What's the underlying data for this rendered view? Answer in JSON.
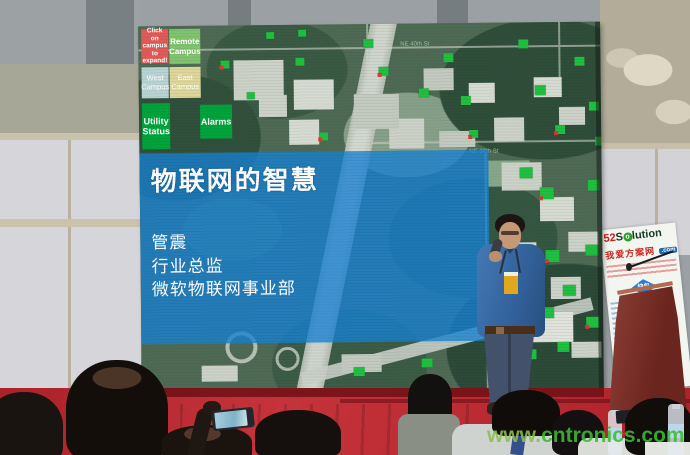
{
  "scene": {
    "description": "conference presentation photo",
    "watermark_prefix": "www.",
    "watermark_main": "cntronics.com",
    "stage_color": "#c2262e",
    "overlay_color": "#1782d4",
    "marker_color": "#1fc040"
  },
  "screen_ui": {
    "buttons": [
      {
        "label": "Click on campus to expand!",
        "color": "#e15a56"
      },
      {
        "label": "Remote Campus",
        "color": "#7fc36e"
      },
      {
        "label": "West Campus",
        "color": "#b7d3d3"
      },
      {
        "label": "East Campus",
        "color": "#ddd69a"
      },
      {
        "label": "Utility Status",
        "color": "#00a33c"
      },
      {
        "label": "Alarms",
        "color": "#00a33c"
      }
    ],
    "map_labels": [
      {
        "text": "NE 40th St",
        "x": 262,
        "y": 18
      },
      {
        "text": "NE 36th St",
        "x": 330,
        "y": 126
      }
    ],
    "markers": [
      {
        "x": 82,
        "y": 35,
        "w": 9,
        "h": 8,
        "red": true
      },
      {
        "x": 108,
        "y": 67,
        "w": 8,
        "h": 7,
        "red": false
      },
      {
        "x": 128,
        "y": 7,
        "w": 8,
        "h": 7,
        "red": false
      },
      {
        "x": 157,
        "y": 33,
        "w": 9,
        "h": 8,
        "red": false
      },
      {
        "x": 160,
        "y": 5,
        "w": 8,
        "h": 7,
        "red": false
      },
      {
        "x": 180,
        "y": 108,
        "w": 9,
        "h": 8,
        "red": true
      },
      {
        "x": 225,
        "y": 15,
        "w": 10,
        "h": 9,
        "red": false
      },
      {
        "x": 240,
        "y": 43,
        "w": 10,
        "h": 9,
        "red": true
      },
      {
        "x": 280,
        "y": 65,
        "w": 10,
        "h": 9,
        "red": false
      },
      {
        "x": 305,
        "y": 30,
        "w": 10,
        "h": 9,
        "red": false
      },
      {
        "x": 322,
        "y": 73,
        "w": 10,
        "h": 9,
        "red": false
      },
      {
        "x": 330,
        "y": 107,
        "w": 9,
        "h": 8,
        "red": true
      },
      {
        "x": 380,
        "y": 17,
        "w": 10,
        "h": 9,
        "red": false
      },
      {
        "x": 396,
        "y": 63,
        "w": 11,
        "h": 10,
        "red": false
      },
      {
        "x": 416,
        "y": 103,
        "w": 10,
        "h": 9,
        "red": true
      },
      {
        "x": 436,
        "y": 35,
        "w": 10,
        "h": 9,
        "red": false
      },
      {
        "x": 450,
        "y": 80,
        "w": 10,
        "h": 9,
        "red": false
      },
      {
        "x": 380,
        "y": 145,
        "w": 13,
        "h": 11,
        "red": false
      },
      {
        "x": 400,
        "y": 165,
        "w": 14,
        "h": 12,
        "red": true
      },
      {
        "x": 448,
        "y": 158,
        "w": 12,
        "h": 11,
        "red": false
      },
      {
        "x": 405,
        "y": 228,
        "w": 14,
        "h": 12,
        "red": true
      },
      {
        "x": 445,
        "y": 223,
        "w": 13,
        "h": 11,
        "red": false
      },
      {
        "x": 422,
        "y": 263,
        "w": 13,
        "h": 11,
        "red": false
      },
      {
        "x": 400,
        "y": 285,
        "w": 13,
        "h": 11,
        "red": false
      },
      {
        "x": 445,
        "y": 295,
        "w": 13,
        "h": 11,
        "red": true
      },
      {
        "x": 383,
        "y": 327,
        "w": 12,
        "h": 10,
        "red": false
      },
      {
        "x": 416,
        "y": 320,
        "w": 12,
        "h": 10,
        "red": false
      },
      {
        "x": 212,
        "y": 343,
        "w": 11,
        "h": 9,
        "red": false
      },
      {
        "x": 280,
        "y": 335,
        "w": 11,
        "h": 9,
        "red": false
      },
      {
        "x": 456,
        "y": 115,
        "w": 8,
        "h": 9,
        "red": false
      }
    ]
  },
  "slide": {
    "title": "物联网的智慧",
    "speaker_lines": [
      "管震",
      "行业总监",
      "微软物联网事业部"
    ]
  },
  "sponsor_banner": {
    "brand_num": "52",
    "brand_s": "S",
    "brand_o": "o",
    "brand_rest": "lution",
    "brand_cn": "我爱方案网",
    "brand_tld": ".com",
    "sub_logo": "快包"
  }
}
